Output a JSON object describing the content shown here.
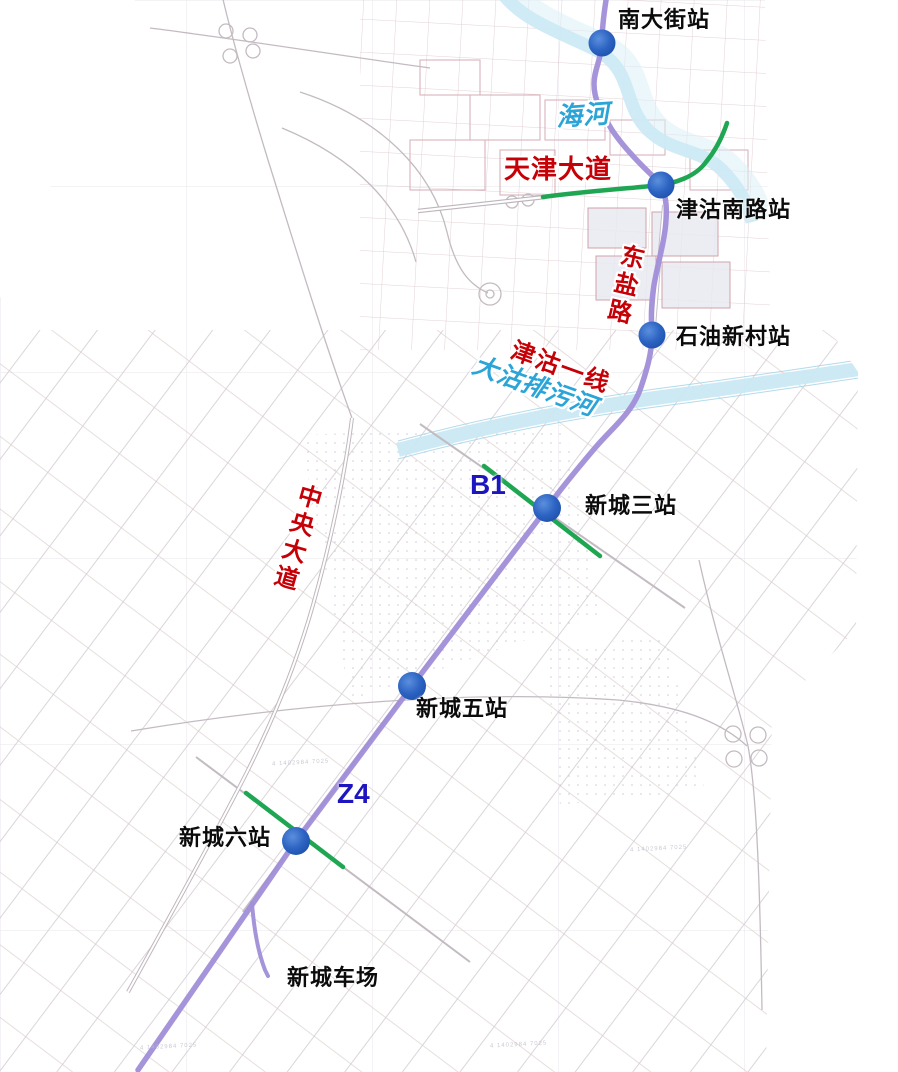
{
  "map_type": "transit-planning-map",
  "lines": {
    "main": {
      "name": "津沽一线",
      "color": "#a18ed9"
    },
    "b1": {
      "label": "B1",
      "color": "#1fa652"
    },
    "z4": {
      "label": "Z4",
      "color": "#1fa652"
    }
  },
  "stations": [
    {
      "name": "南大街站"
    },
    {
      "name": "津沽南路站"
    },
    {
      "name": "石油新村站"
    },
    {
      "name": "新城三站"
    },
    {
      "name": "新城五站"
    },
    {
      "name": "新城六站"
    }
  ],
  "depot": {
    "name": "新城车场"
  },
  "roads": {
    "tianjin_avenue": {
      "name": "天津大道"
    },
    "dongyan_road": {
      "name": "东盐路"
    },
    "central_avenue": {
      "name": "中央大道"
    }
  },
  "rivers": {
    "haihe": {
      "name": "海河"
    },
    "dagu_drainage": {
      "name": "大沽排污河"
    }
  },
  "colors": {
    "metro_purple": "#a18ed9",
    "link_green": "#1fa652",
    "station_blue": "#2b63c3",
    "road_label_red": "#c50006",
    "water_label_blue": "#2ba4d8",
    "code_label_blue": "#1d16c0"
  },
  "stamps": {
    "survey_note": "4 1402984 7025"
  }
}
